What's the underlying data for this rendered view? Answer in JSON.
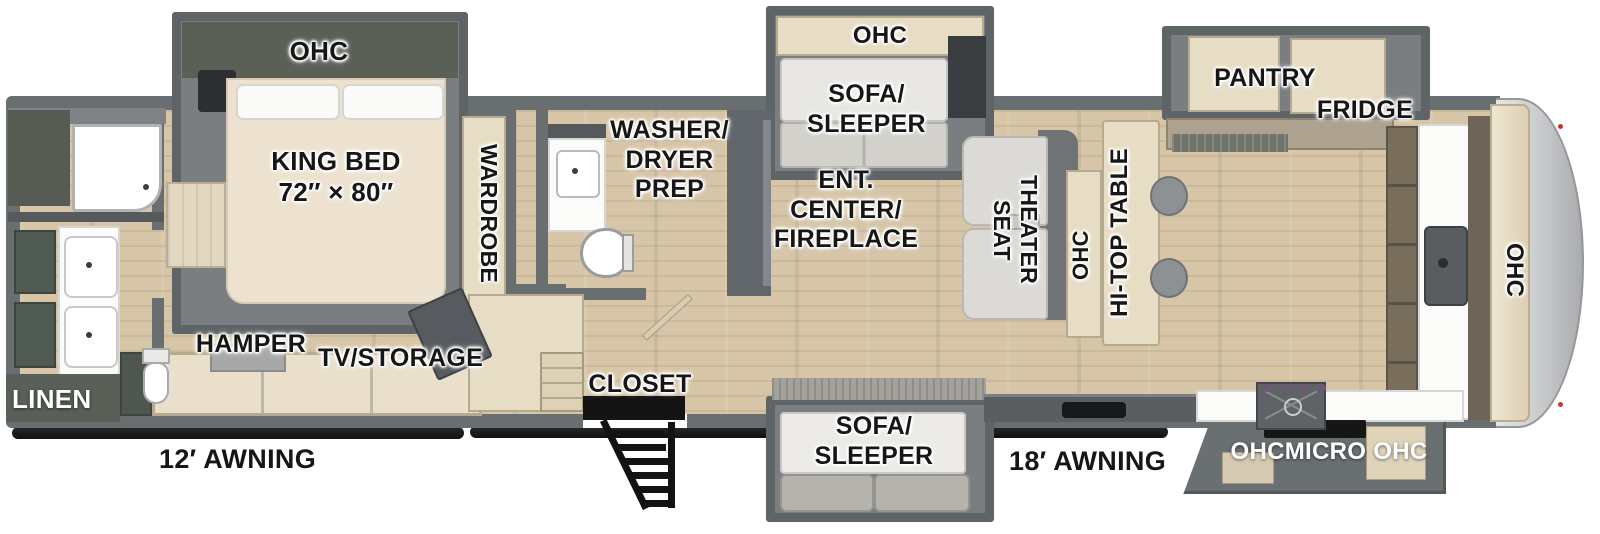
{
  "type": "rv-floor-plan-diagram",
  "labels": {
    "bedroom": {
      "ohc": "OHC",
      "king_bed": "KING BED\n72″ × 80″",
      "wardrobe": "WARDROBE",
      "hamper": "HAMPER",
      "tv_storage": "TV/STORAGE"
    },
    "rear_bath": {
      "linen": "LINEN"
    },
    "mid_bath": {
      "washer_dryer_prep": "WASHER/\nDRYER\nPREP",
      "closet": "CLOSET"
    },
    "living": {
      "sofa_ohc": "OHC",
      "sofa_sleeper_top": "SOFA/\nSLEEPER",
      "ent_center": "ENT.\nCENTER/\nFIREPLACE",
      "theater_seat": "THEATER\nSEAT",
      "sofa_sleeper_bottom": "SOFA/\nSLEEPER"
    },
    "kitchen": {
      "ohc_wall": "OHC",
      "hi_top_table": "HI-TOP TABLE",
      "pantry": "PANTRY",
      "fridge": "FRIDGE",
      "ohc_front": "OHC",
      "ohc_micro_ohc": "OHCMICRO OHC"
    },
    "exterior": {
      "awning_left": "12′ AWNING",
      "awning_right": "18′ AWNING"
    }
  },
  "colors": {
    "wall": "#696e71",
    "floor_wood": "#d6c5a7",
    "cabinet_tan": "#e7dcc4",
    "slide_interior": "#7a7e81",
    "overhead_cabinet_green": "#5b6057",
    "vanity_green": "#4e5a52",
    "counter_white": "#fbfbfa",
    "sofa_gray": "#e8e7e3",
    "cushion_gray": "#b5b3ae",
    "front_cap_gray": "#c6c8ca",
    "awning_black": "#171717",
    "label_text": "#161616",
    "label_text_white": "#ffffff"
  }
}
